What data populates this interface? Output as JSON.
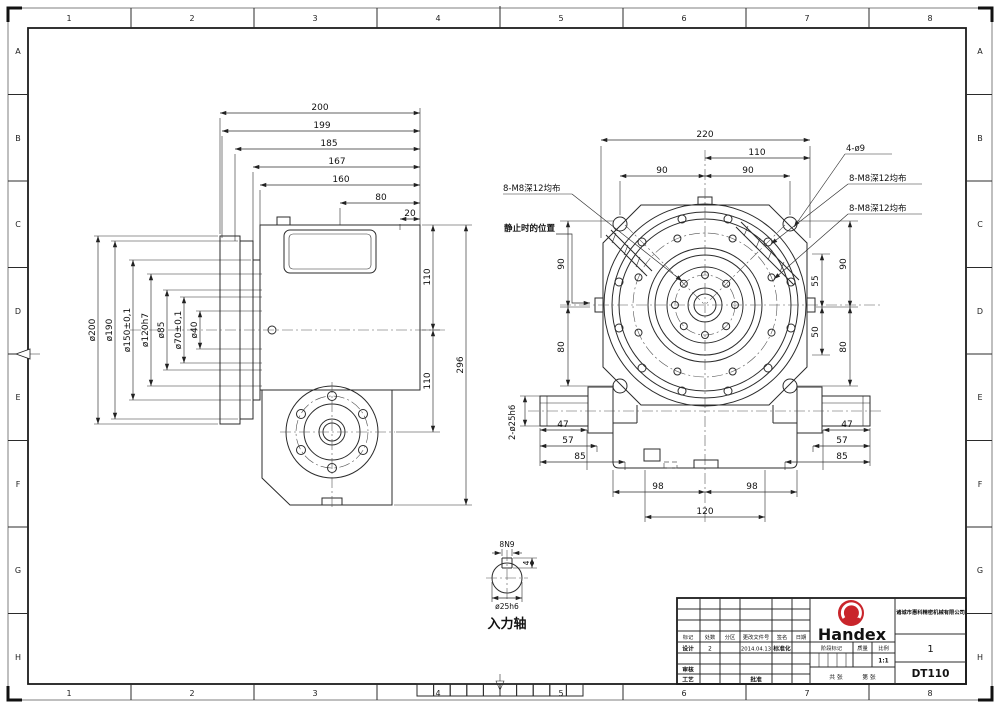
{
  "border": {
    "cols": [
      "1",
      "2",
      "3",
      "4",
      "5",
      "6",
      "7",
      "8"
    ],
    "rows": [
      "A",
      "B",
      "C",
      "D",
      "E",
      "F",
      "G",
      "H"
    ]
  },
  "side_view": {
    "top_dims": [
      "200",
      "199",
      "185",
      "167",
      "160",
      "80",
      "20"
    ],
    "dia_dims": [
      "ø200",
      "ø190",
      "ø150±0,1",
      "ø120h7",
      "ø85",
      "ø70±0,1",
      "ø40"
    ],
    "side_dims": [
      "110",
      "110",
      "296"
    ]
  },
  "front_view": {
    "top_dims": [
      "220",
      "110",
      "90",
      "90"
    ],
    "callouts": {
      "holes": "4-ø9",
      "taps_outer": "8-M8深12均布",
      "taps_mid": "8-M8深12均布",
      "taps_hub": "8-M8深12均布",
      "rest": "静止时的位置",
      "shaft": "2-ø25h6"
    },
    "left_dims": [
      "90",
      "80"
    ],
    "right_inner_dims": [
      "55",
      "50"
    ],
    "right_outer_dims": [
      "90",
      "80"
    ],
    "bottom_left_dims": [
      "47",
      "57",
      "85"
    ],
    "bottom_right_dims": [
      "47",
      "57",
      "85"
    ],
    "bottom_center_dims": [
      "98",
      "98",
      "120"
    ]
  },
  "shaft_detail": {
    "key_width": "8N9",
    "key_depth": "4",
    "dia": "ø25h6",
    "label": "入力轴"
  },
  "title_block": {
    "brand": "Handex",
    "company": "诸城市惠科精密机械有限公司",
    "sheet_no": "1",
    "model": "DT110",
    "h_mark": "标记",
    "h_count": "处数",
    "h_zone": "分区",
    "h_file": "更改文件号",
    "h_sign": "签名",
    "h_date": "日期",
    "design": "设计",
    "design_sign": "2",
    "design_date": "2014.04.13",
    "standard": "标准化",
    "review": "审核",
    "process": "工艺",
    "approve": "批准",
    "stage": "阶段标记",
    "weight": "质量",
    "scale_label": "比例",
    "scale_value": "1:1",
    "sheets": "共 张",
    "sheet": "第 张"
  }
}
